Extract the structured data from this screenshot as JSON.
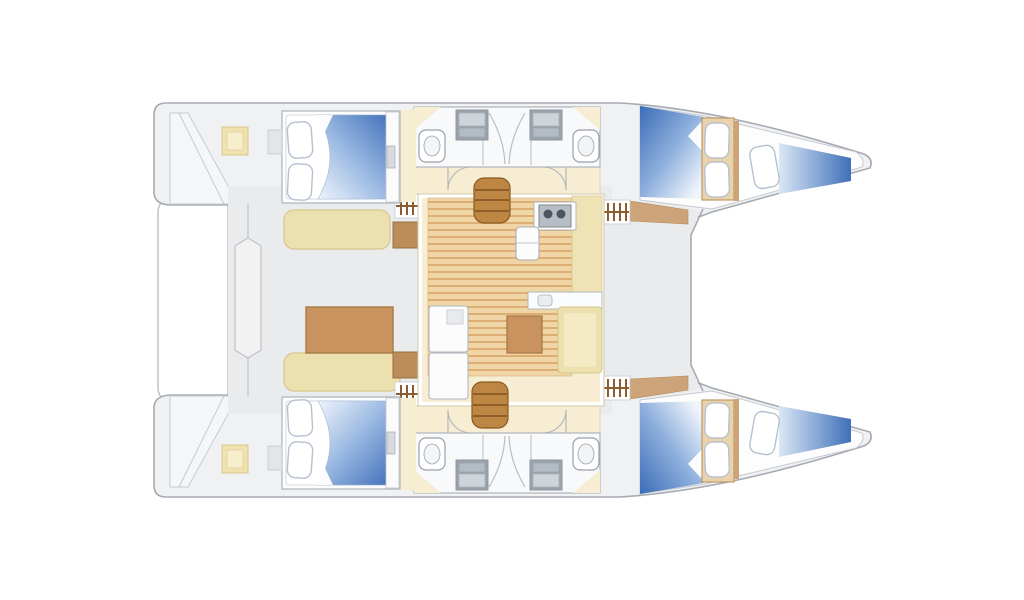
{
  "meta": {
    "type": "catamaran-interior-floorplan",
    "view": "top-down",
    "canvas_width": 1024,
    "canvas_height": 600
  },
  "palette": {
    "background": "#ffffff",
    "hull_fill": "#f0f1f3",
    "hull_stroke": "#a6abb3",
    "deck_fill": "#e9ebed",
    "floor_beige": "#f6edd3",
    "floor_beige_stroke": "#d9d0b0",
    "wood_light": "#f0d5a6",
    "wood_stripe": "#dcae74",
    "stair_wood": "#bd8743",
    "stair_line": "#7e5120",
    "table_wood": "#c9935f",
    "table_stroke": "#a97a44",
    "desk_wood": "#bc8c5a",
    "sidedeck_wood": "#cda47a",
    "bench_fill": "#ece0ae",
    "bench_stroke": "#d6c68d",
    "bench_inner": "#f4ebc4",
    "counter_beige": "#efe3b6",
    "duvet_deep": "#3a6cb7",
    "duvet_mid": "#9dbbe3",
    "duvet_light": "#eff4fb",
    "pillow_fill": "#ffffff",
    "pillow_stroke": "#b7c1d2",
    "fixture_fill": "#fbfcfd",
    "fixture_stroke": "#aab0b7",
    "sink_dark": "#9aa2ab",
    "sink_light": "#cdd4da",
    "burner_dark": "#4e545b",
    "wall_stroke": "#c6cacf",
    "helm_fill": "#f2f2f3"
  },
  "features": {
    "hulls": 2,
    "double_beds": 4,
    "forepeak_berths": 2,
    "bathrooms": 4,
    "toilets": 4,
    "bathroom_sinks": 4,
    "shower_doors": 4,
    "staircases": 2,
    "companionway_step_markers": 4,
    "door_swings": 4,
    "galley_stove_burners": 2,
    "fridge": 1,
    "galley_counter_sink": 1,
    "salon_table": 1,
    "cockpit_benches": 2,
    "cockpit_table": 1,
    "helm_seat": 1,
    "cockpit_corner_seats": 2,
    "transom_step_platforms": 2
  }
}
